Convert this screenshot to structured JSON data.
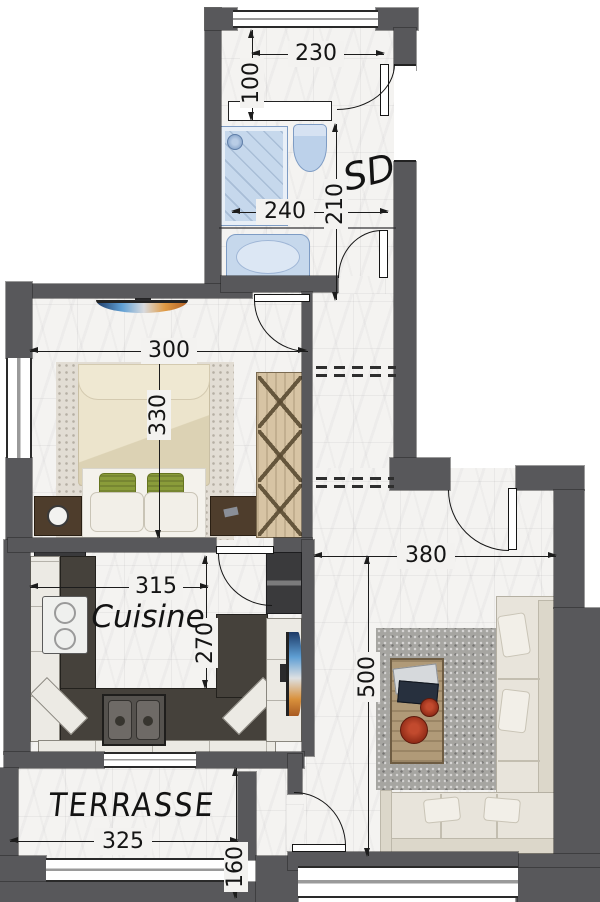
{
  "plan": {
    "rooms": {
      "shower_room_label": "SD",
      "kitchen_label": "Cuisine",
      "terrace_label": "TERRASSE"
    },
    "dimensions": {
      "entry_width": "230",
      "entry_depth": "100",
      "shower_room_width": "240",
      "shower_room_length": "210",
      "bedroom_width": "300",
      "bedroom_length": "330",
      "kitchen_width": "315",
      "kitchen_depth": "270",
      "living_width": "380",
      "living_length": "500",
      "terrace_width": "325",
      "terrace_depth": "160"
    },
    "colors": {
      "wall": "#58585b",
      "floor": "#f3f2f0",
      "fixture_blue": "#c6d8ec",
      "counter_dark": "#45413b",
      "cabinet_white": "#eceae4",
      "wardrobe_wood": "#d7c4a4",
      "pillow_green": "#8a9c3a",
      "sofa_cream": "#e8e4db",
      "bowl_red": "#a93420"
    }
  }
}
